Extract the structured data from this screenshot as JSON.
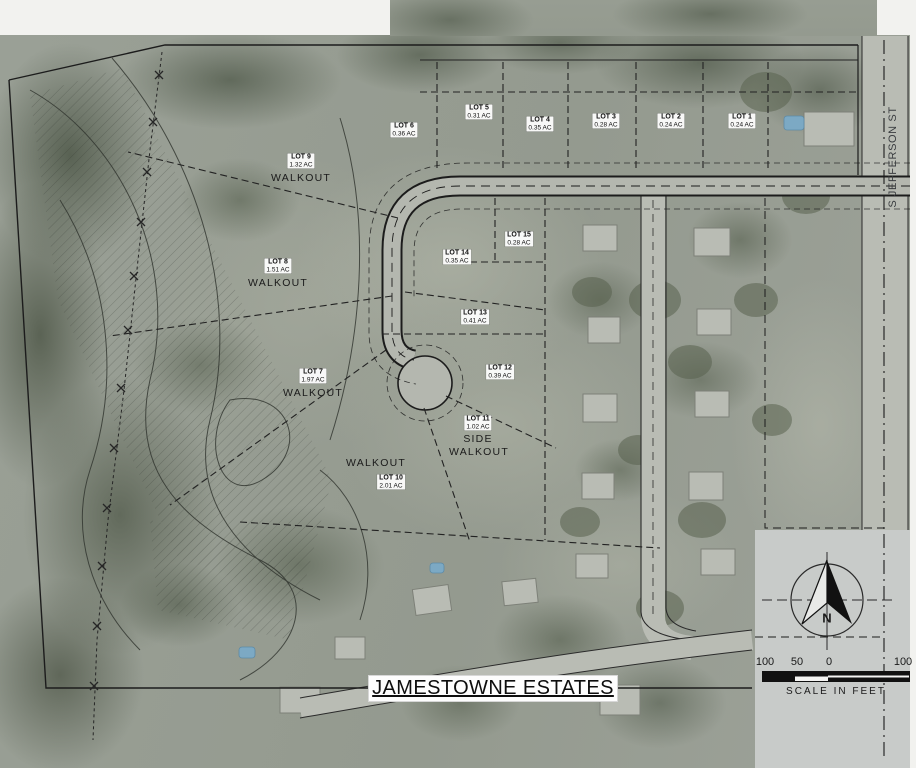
{
  "map": {
    "title": "JAMESTOWNE ESTATES",
    "streets": {
      "side_street": "S JEFFERSON ST",
      "bottom_street": "JAMESTOWNE ESTATES"
    }
  },
  "lots": [
    {
      "name": "LOT 1",
      "area": "0.24 AC"
    },
    {
      "name": "LOT 2",
      "area": "0.24 AC"
    },
    {
      "name": "LOT 3",
      "area": "0.28 AC"
    },
    {
      "name": "LOT 4",
      "area": "0.35 AC"
    },
    {
      "name": "LOT 5",
      "area": "0.31 AC"
    },
    {
      "name": "LOT 6",
      "area": "0.36 AC"
    },
    {
      "name": "LOT 7",
      "area": "1.97 AC",
      "note": "WALKOUT"
    },
    {
      "name": "LOT 8",
      "area": "1.51 AC",
      "note": "WALKOUT"
    },
    {
      "name": "LOT 9",
      "area": "1.32 AC",
      "note": "WALKOUT"
    },
    {
      "name": "LOT 10",
      "area": "2.01 AC",
      "note": "WALKOUT"
    },
    {
      "name": "LOT 11",
      "area": "1.02 AC",
      "note": "SIDE WALKOUT"
    },
    {
      "name": "LOT 12",
      "area": "0.39 AC"
    },
    {
      "name": "LOT 13",
      "area": "0.41 AC"
    },
    {
      "name": "LOT 14",
      "area": "0.35 AC"
    },
    {
      "name": "LOT 15",
      "area": "0.28 AC"
    }
  ],
  "compass": {
    "north_label": "N"
  },
  "scale": {
    "ticks": [
      "100",
      "50",
      "0",
      "100"
    ],
    "caption": "SCALE IN FEET"
  },
  "colors": {
    "aerial_base": "#99A094",
    "linework": "#1C1C1C",
    "road_fill": "#B6B9B1",
    "pool": "#7CA9C4",
    "panel": "#C8CBC9",
    "label_bg": "#FFFFFF"
  }
}
